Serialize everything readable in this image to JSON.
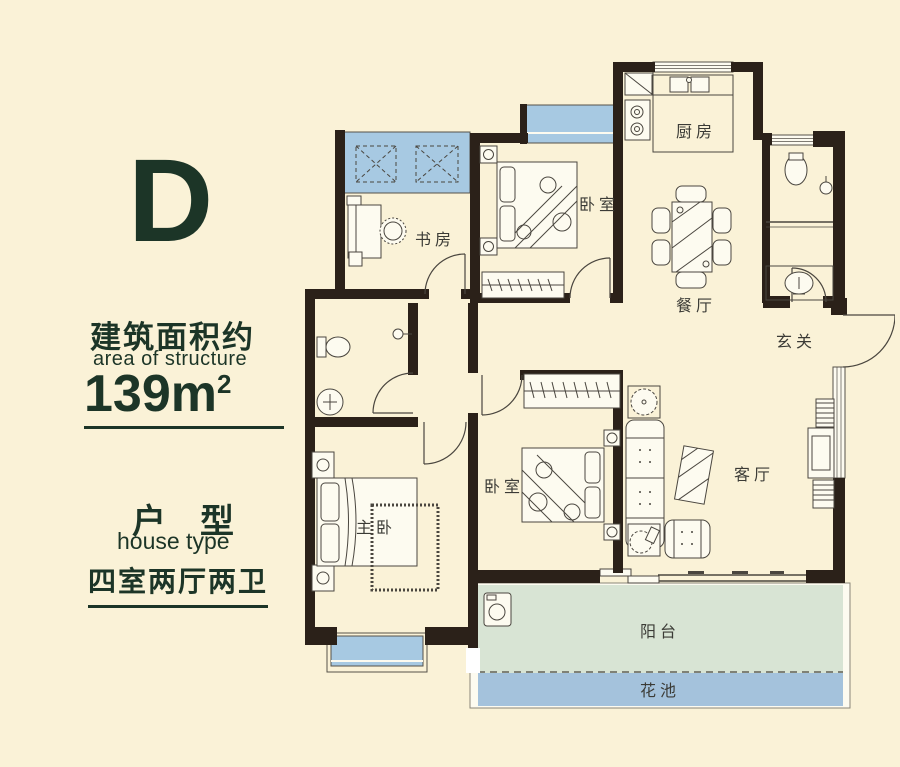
{
  "colors": {
    "background": "#FAF2D7",
    "ink": "#1C3527",
    "wall": "#2B2119",
    "window_blue": "#A7C9E2",
    "balcony_green": "#D8E4D4",
    "flowerbed_blue": "#A4C2DC",
    "line": "#4A463F"
  },
  "sidebar": {
    "type_letter": "D",
    "area_title_zh": "建筑面积约",
    "area_title_en": "area of structure",
    "area_value": "139m",
    "area_unit_sup": "2",
    "type_title_zh": "户　型",
    "type_title_en": "house type",
    "layout_summary": "四室两厅两卫"
  },
  "rooms": {
    "study": "书房",
    "bedroom_top": "卧室",
    "kitchen": "厨房",
    "dining": "餐厅",
    "foyer": "玄关",
    "master_bedroom": "主卧",
    "bedroom_mid": "卧室",
    "living": "客厅",
    "balcony": "阳台",
    "flower_bed": "花池"
  }
}
